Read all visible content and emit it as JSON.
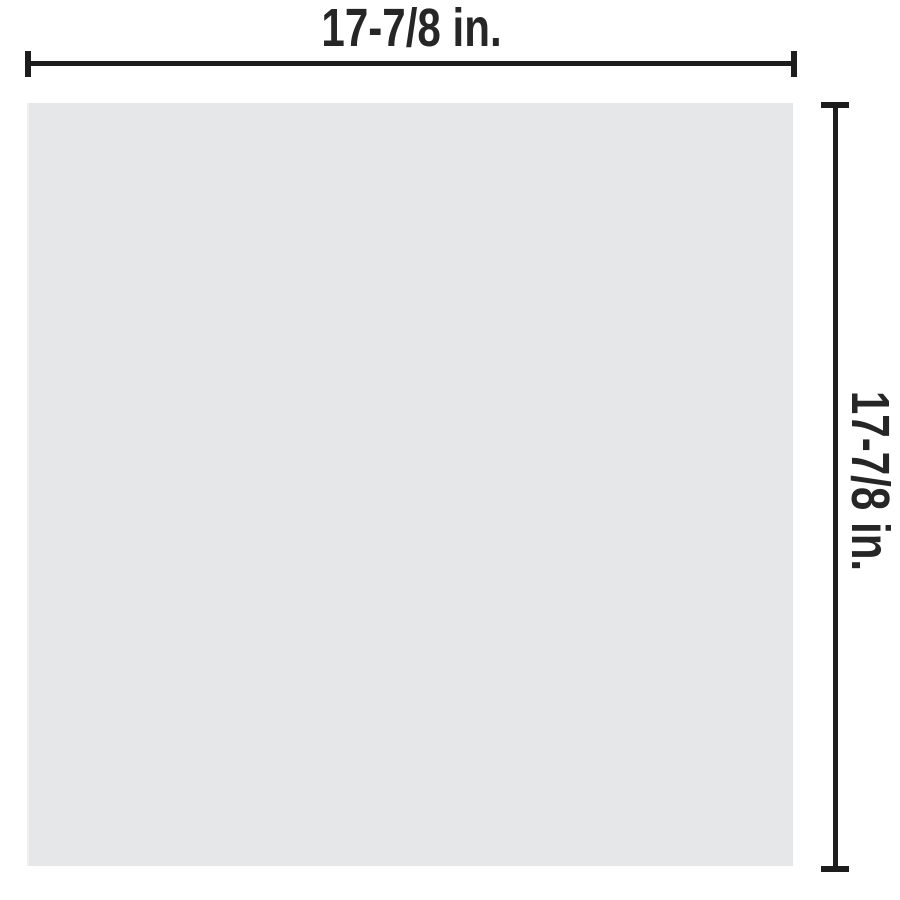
{
  "diagram": {
    "type": "product-dimension-diagram",
    "shape": "square",
    "width_dimension": {
      "label": "17-7/8 in.",
      "position": "top"
    },
    "height_dimension": {
      "label": "17-7/8 in.",
      "position": "right",
      "rotation_deg": 90
    },
    "colors": {
      "background": "#ffffff",
      "panel": "#e6e7e9",
      "line": "#1d1d1d",
      "text": "#262626"
    }
  }
}
